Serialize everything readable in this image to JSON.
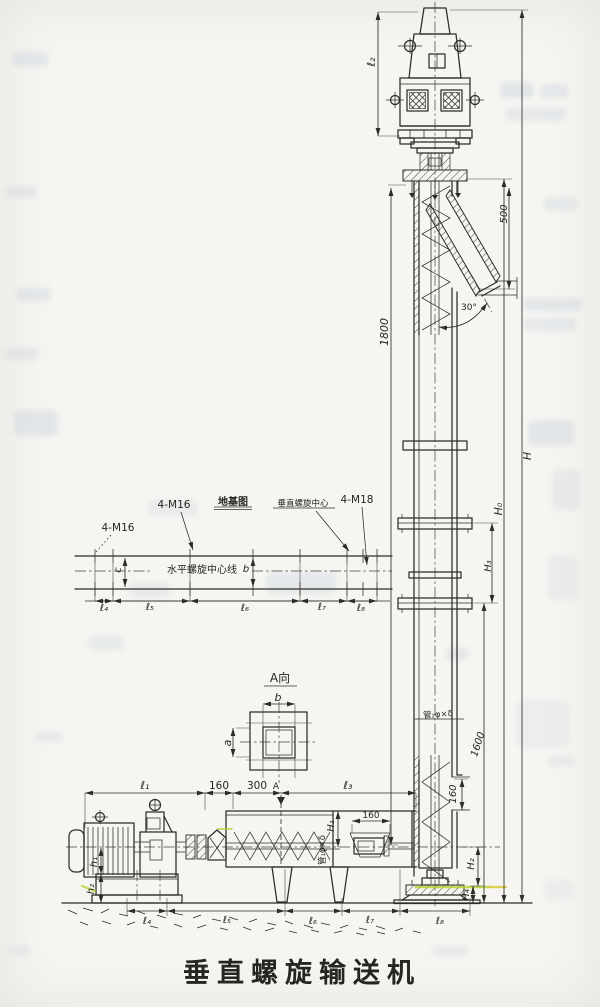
{
  "drawing_title": "垂直螺旋输送机",
  "colors": {
    "ink": "#2e2c28",
    "paper": "#f6f5f1",
    "highlight_green": "#b8cf2f",
    "highlight_yellow": "#d6c92f",
    "ghost_blue": "#b9c6da"
  },
  "labels": {
    "dim_l2_top": "ℓ₂",
    "dim_500": "500",
    "angle_30": "30°",
    "dim_1800": "1800",
    "dim_H": "H",
    "dim_H0": "H₀",
    "dim_H3": "H₃",
    "dim_1600": "1600",
    "dim_160_inlet": "160",
    "pipe2_spec": "管₂φ×δ",
    "pipe1_spec": "管₁φ×δ",
    "plan_m16_left": "4-M16",
    "plan_m16_mid": "4-M16",
    "plan_title": "地基图",
    "plan_vertical_center": "垂直螺旋中心",
    "plan_m18": "4-M18",
    "plan_horizontal_center": "水平螺旋中心线",
    "dim_c": "c",
    "dim_b_plan": "b",
    "plan_l4": "ℓ₄",
    "plan_l5": "ℓ₅",
    "plan_l6": "ℓ₆",
    "plan_l7": "ℓ₇",
    "plan_l8": "ℓ₈",
    "viewA_title": "A向",
    "dim_b": "b",
    "dim_a": "a",
    "dim_l1": "ℓ₁",
    "dim_160_top": "160",
    "dim_300": "300",
    "marker_A": "A",
    "dim_l3": "ℓ₃",
    "dim_160_hopper": "160",
    "dim_H1": "H₁",
    "dim_h1": "h₁",
    "dim_h2": "h₂",
    "dim_H2": "H₂",
    "dim_H4": "H₄",
    "elev_l4": "ℓ₄",
    "elev_l5": "ℓ₅",
    "elev_l6": "ℓ₆",
    "elev_l7": "ℓ₇",
    "elev_l8": "ℓ₈"
  }
}
